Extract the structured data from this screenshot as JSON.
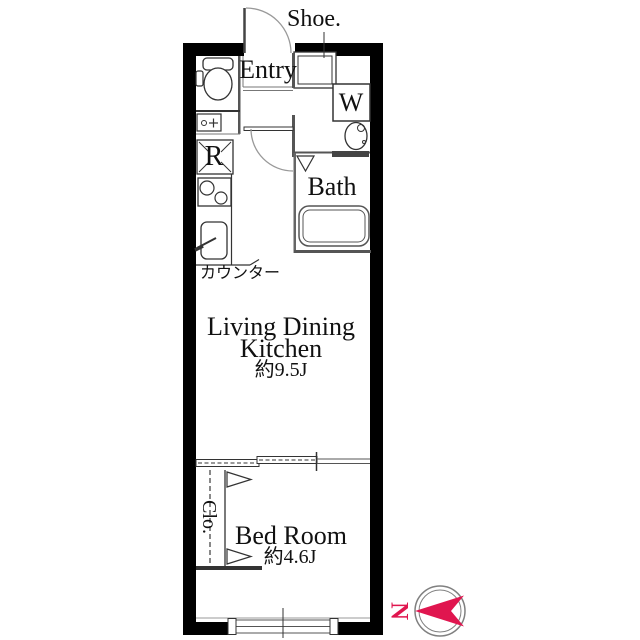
{
  "labels": {
    "shoe": "Shoe.",
    "entry": "Entry",
    "washer": "W",
    "refrigerator": "R",
    "bath": "Bath",
    "counter": "カウンター",
    "ldk_line1": "Living Dining",
    "ldk_line2": "Kitchen",
    "ldk_area": "約9.5J",
    "closet": "Clo.",
    "bedroom": "Bed Room",
    "bedroom_area": "約4.6J",
    "compass_north": "N"
  },
  "rooms": [
    {
      "name": "Living Dining Kitchen",
      "area": "約9.5J"
    },
    {
      "name": "Bed Room",
      "area": "約4.6J"
    },
    {
      "name": "Bath",
      "area": ""
    },
    {
      "name": "Entry",
      "area": ""
    },
    {
      "name": "Clo.",
      "area": ""
    }
  ],
  "colors": {
    "wall": "#000000",
    "line": "#333333",
    "light_line": "#777777",
    "compass_red": "#e0164f",
    "ring_gray": "#808080"
  }
}
